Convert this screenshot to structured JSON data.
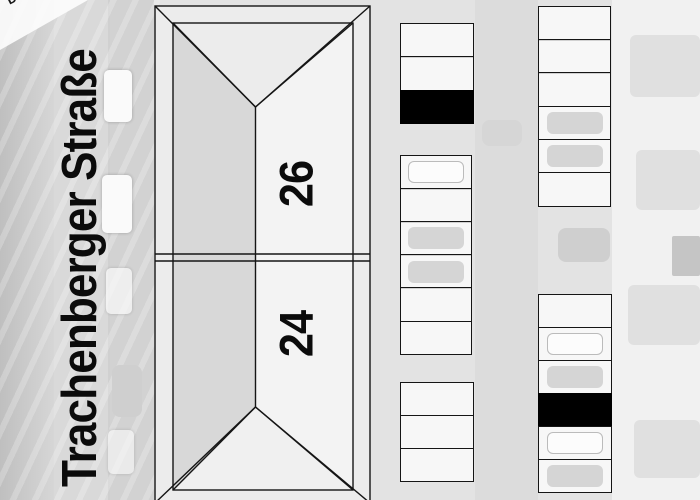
{
  "street": {
    "label": "Trachenberger Straße"
  },
  "corner_label": "Dra",
  "buildings": [
    {
      "number": "26"
    },
    {
      "number": "24"
    }
  ],
  "colors": {
    "line": "#151515",
    "occupied_stall": "#000000",
    "roof_west_plane": "#d8d8d8",
    "roof_east_plane": "#f3f3f3"
  },
  "parking_groups": [
    {
      "name": "stall-row-a-top",
      "x": 400,
      "y": 23,
      "width": 74,
      "stall_height": 34.7,
      "stalls": [
        {
          "filled": false,
          "car": "none"
        },
        {
          "filled": false,
          "car": "none"
        },
        {
          "filled": true,
          "car": "none"
        }
      ]
    },
    {
      "name": "stall-row-a-middle",
      "x": 400,
      "y": 155,
      "width": 72,
      "stall_height": 34.5,
      "stalls": [
        {
          "filled": false,
          "car": "light"
        },
        {
          "filled": false,
          "car": "none"
        },
        {
          "filled": false,
          "car": "gray"
        },
        {
          "filled": false,
          "car": "gray"
        },
        {
          "filled": false,
          "car": "none"
        },
        {
          "filled": false,
          "car": "none"
        }
      ]
    },
    {
      "name": "stall-row-a-bottom",
      "x": 400,
      "y": 382,
      "width": 74,
      "stall_height": 34.4,
      "stalls": [
        {
          "filled": false,
          "car": "none"
        },
        {
          "filled": false,
          "car": "none"
        },
        {
          "filled": false,
          "car": "none"
        }
      ]
    },
    {
      "name": "stall-row-b-top",
      "x": 538,
      "y": 6,
      "width": 73,
      "stall_height": 34.6,
      "stalls": [
        {
          "filled": false,
          "car": "none"
        },
        {
          "filled": false,
          "car": "none"
        },
        {
          "filled": false,
          "car": "none"
        },
        {
          "filled": false,
          "car": "gray"
        },
        {
          "filled": false,
          "car": "gray"
        },
        {
          "filled": false,
          "car": "none"
        }
      ]
    },
    {
      "name": "stall-row-b-bottom",
      "x": 538,
      "y": 294,
      "width": 74,
      "stall_height": 34.4,
      "stalls": [
        {
          "filled": false,
          "car": "none"
        },
        {
          "filled": false,
          "car": "light"
        },
        {
          "filled": false,
          "car": "gray"
        },
        {
          "filled": true,
          "car": "none"
        },
        {
          "filled": false,
          "car": "light"
        },
        {
          "filled": false,
          "car": "gray"
        }
      ]
    }
  ]
}
